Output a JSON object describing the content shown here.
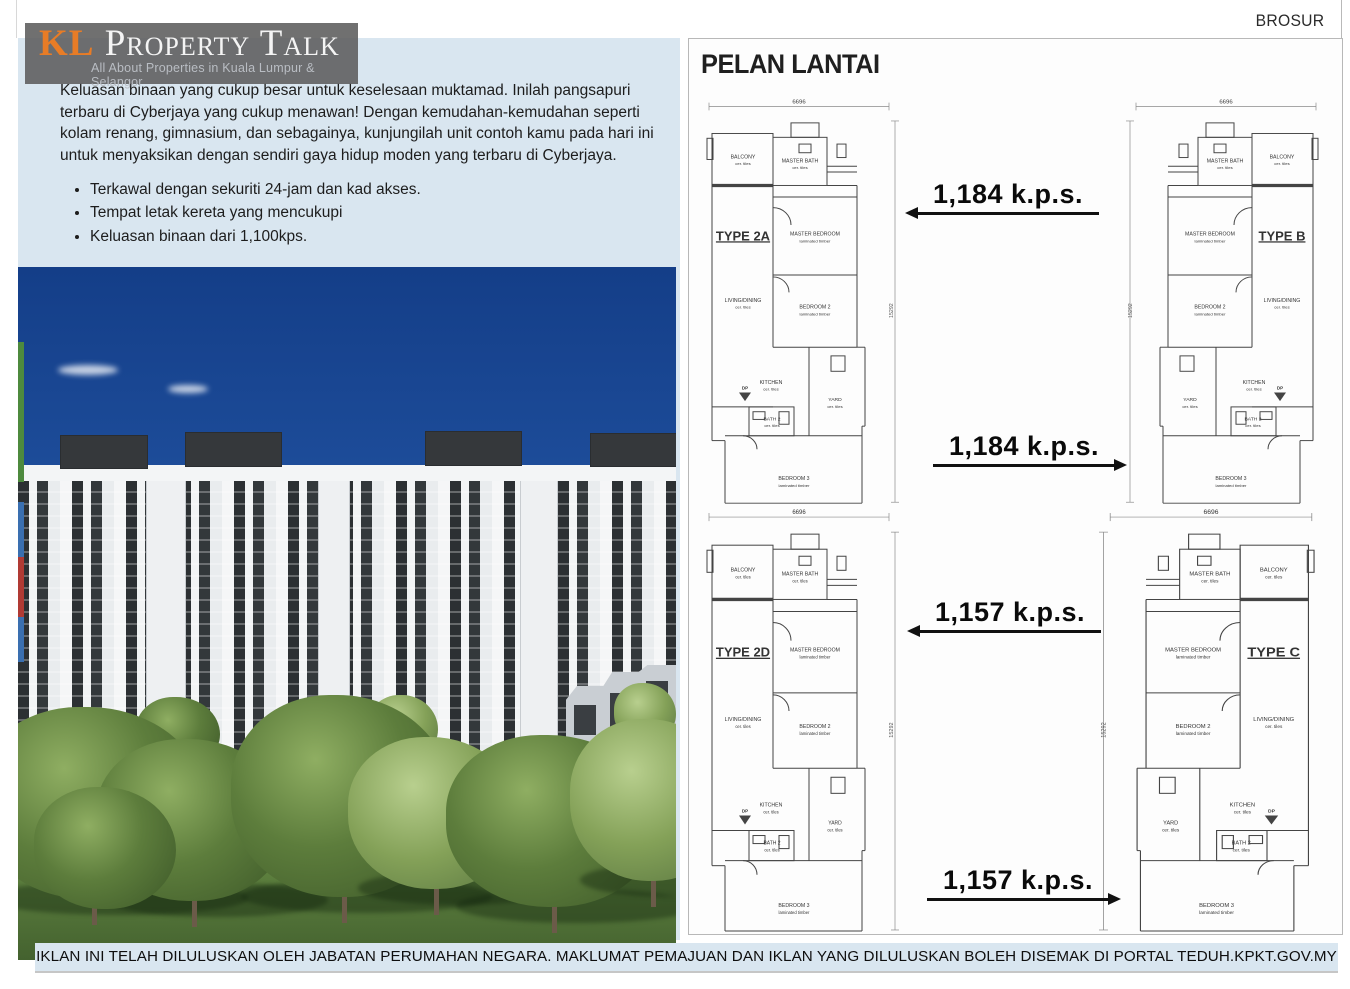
{
  "header": {
    "doc_label": "BROSUR"
  },
  "logo": {
    "prefix": "KL",
    "name": "Property Talk",
    "tagline": "All About Properties in Kuala Lumpur & Selangor"
  },
  "intro": {
    "paragraph": "Keluasan binaan yang cukup besar untuk keselesaan muktamad. Inilah pangsapuri terbaru di Cyberjaya yang cukup menawan! Dengan kemudahan-kemudahan seperti kolam renang, gimnasium, dan sebagainya, kunjungilah unit contoh kamu pada hari ini untuk menyaksikan dengan sendiri gaya hidup moden yang terbaru di Cyberjaya.",
    "bullets": [
      "Terkawal dengan sekuriti 24-jam dan kad akses.",
      "Tempat letak kereta yang mencukupi",
      "Keluasan binaan dari 1,100kps."
    ]
  },
  "floorplans": {
    "title": "PELAN LANTAI",
    "width_dim": "6696",
    "height_dim": "15292",
    "plans": [
      {
        "type_label": "TYPE 2A",
        "mirrored": false
      },
      {
        "type_label": "TYPE B",
        "mirrored": true
      },
      {
        "type_label": "TYPE 2D",
        "mirrored": false
      },
      {
        "type_label": "TYPE C",
        "mirrored": true
      }
    ],
    "areas": [
      {
        "label": "1,184 k.p.s.",
        "arrow": "left"
      },
      {
        "label": "1,184 k.p.s.",
        "arrow": "right"
      },
      {
        "label": "1,157 k.p.s.",
        "arrow": "left"
      },
      {
        "label": "1,157 k.p.s.",
        "arrow": "right"
      }
    ],
    "room_labels": {
      "balcony": "BALCONY",
      "master_bath": "MASTER BATH",
      "master_bedroom": "MASTER BEDROOM",
      "living_dining": "LIVING/DINING",
      "bedroom2": "BEDROOM 2",
      "kitchen": "KITCHEN",
      "yard": "YARD",
      "bath2": "BATH 2",
      "bedroom3": "BEDROOM 3",
      "dp": "DP",
      "cer_tiles": "cer. tiles",
      "laminated_timber": "laminated timber"
    }
  },
  "footer": {
    "disclaimer": "IKLAN INI TELAH DILULUSKAN OLEH JABATAN PERUMAHAN NEGARA. MAKLUMAT PEMAJUAN DAN IKLAN YANG DILULUSKAN BOLEH DISEMAK DI PORTAL TEDUH.KPKT.GOV.MY"
  },
  "colors": {
    "accent_orange": "#e87c26",
    "panel_blue": "#d9e6f0",
    "plan_ink": "#444444"
  }
}
